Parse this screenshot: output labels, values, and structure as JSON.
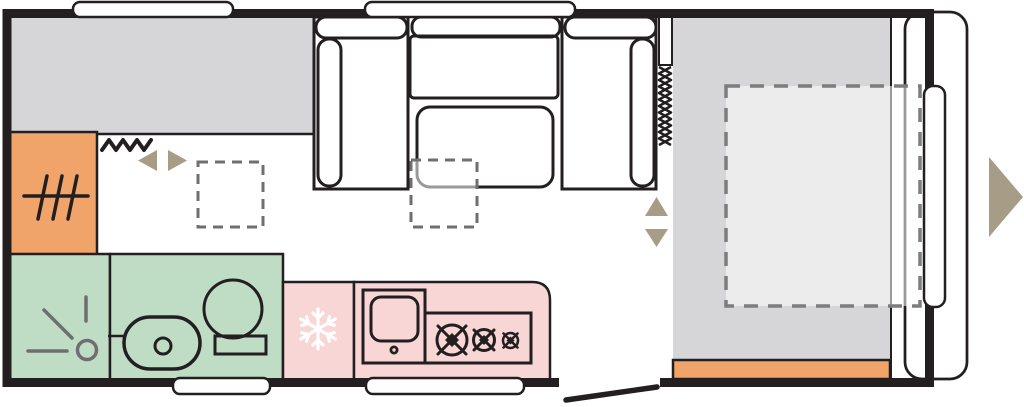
{
  "colors": {
    "wall": "#231f20",
    "bed_gray": "#d6d6d8",
    "accent_orange": "#f0a469",
    "bathroom_green": "#bfddc5",
    "kitchen_pink": "#f8d6d5",
    "sofa_tan": "#ded189",
    "table_tan": "#f0e6ae",
    "shelf_beige": "#dacead",
    "arrow_tan": "#a79d86",
    "symbol_gray": "#6e6e6e",
    "snowflake_white": "#ffffff",
    "window_white": "#ffffff",
    "overlay_white": "rgba(255,255,255,0.55)"
  },
  "plan": {
    "rooms": [
      "side-bed-area",
      "wardrobe",
      "shower-room",
      "toilet-room",
      "kitchen",
      "dinette",
      "front-bed-area"
    ],
    "icons": [
      "wardrobe-icon",
      "curtain-zigzag-icon",
      "slide-left-arrow-icon",
      "slide-right-arrow-icon",
      "shower-icon",
      "toilet-icon",
      "washbasin-icon",
      "snowflake-icon",
      "sink-icon",
      "hob-burner-icon",
      "concertina-door-icon",
      "bed-up-arrow-icon",
      "bed-down-arrow-icon",
      "entry-arrow-icon"
    ],
    "windows": [
      "window-top-left",
      "window-top-center",
      "window-bottom-left",
      "window-bottom-center",
      "window-front"
    ],
    "doors": [
      "entry-door-swing",
      "concertina-door"
    ],
    "dashed_outlines": [
      "floor-footprint-left",
      "floor-footprint-table",
      "bed-extension-outline"
    ]
  }
}
